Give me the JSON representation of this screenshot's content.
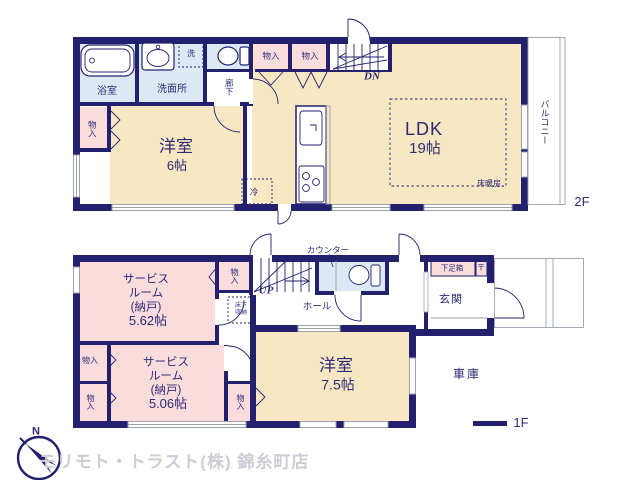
{
  "colors": {
    "wall_navy": "#23206e",
    "room_cream": "#f8e7c3",
    "room_pink": "#fadcdd",
    "room_blue": "#dce8f4",
    "outline_gray": "#9aa0b0",
    "label_navy": "#2d2b75",
    "logo_gray": "#cdcdd6"
  },
  "compass": {
    "north": "N"
  },
  "company": "モリモト・トラスト(株) 錦糸町店",
  "floor2": {
    "label": "2F",
    "bathroom": "浴室",
    "washroom": "洗面所",
    "laundry": "洗",
    "hallway": "廊下",
    "closet_top1": "物入",
    "closet_top2": "物入",
    "closet_left": "物入",
    "stairs_dn": "DN",
    "western_room_name": "洋室",
    "western_room_size": "6帖",
    "ldk_name": "LDK",
    "ldk_size": "19帖",
    "floor_heating": "床暖房",
    "fridge": "冷",
    "balcony": "バルコニー"
  },
  "floor1": {
    "label": "1F",
    "counter": "カウンター",
    "service_room1_name": "サービス\nルーム\n(納戸)",
    "service_room1_size": "5.62帖",
    "service_room2_name": "サービス\nルーム\n(納戸)",
    "service_room2_size": "5.06帖",
    "closet_mid": "物入",
    "underfloor_storage": "床下\n収納",
    "stairs_up": "UP",
    "hall": "ホール",
    "shoe_box": "下足箱",
    "post_mark": "〒",
    "entrance": "玄関",
    "closet_left_upper": "物入",
    "closet_left_lower": "物入",
    "closet_right": "物入",
    "western_room_name": "洋室",
    "western_room_size": "7.5帖",
    "garage": "車庫"
  }
}
